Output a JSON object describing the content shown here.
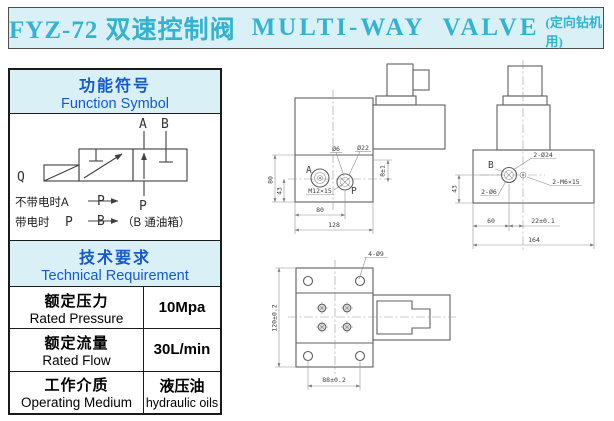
{
  "title": {
    "cn": "FYZ-72 双速控制阀",
    "en": "MULTI-WAY  VALVE",
    "note": "(定向钻机用)"
  },
  "function_symbol": {
    "title_cn": "功能符号",
    "title_en": "Function Symbol",
    "ports": {
      "a": "A",
      "b": "B",
      "p": "P",
      "q": "Q"
    },
    "notes": {
      "line1_prefix": "不带电时A",
      "line1_flow": "P",
      "line2_prefix": "带电时",
      "line2_port": "P",
      "line2_flow": "B",
      "line2_suffix": "（B 通油箱）"
    }
  },
  "technical": {
    "title_cn": "技术要求",
    "title_en": "Technical Requirement",
    "rows": [
      {
        "label_cn": "额定压力",
        "label_en": "Rated Pressure",
        "value": "10Mpa",
        "value_sub": ""
      },
      {
        "label_cn": "额定流量",
        "label_en": "Rated Flow",
        "value": "30L/min",
        "value_sub": ""
      },
      {
        "label_cn": "工作介质",
        "label_en": "Operating Medium",
        "value": "液压油",
        "value_sub": "hydraulic oils"
      }
    ]
  },
  "drawings": {
    "side_view": {
      "port_a": "A",
      "port_p": "P",
      "label_phi6": "Ø6",
      "label_phi22": "Ø22",
      "label_thread": "M12×15",
      "dim_height": "80",
      "dim_port_height": "43",
      "dim_depth": "8±1",
      "dim_port_x": "80",
      "dim_width": "128"
    },
    "front_view": {
      "port_b": "B",
      "label_bore": "2-Ø24",
      "label_thread": "2-M6×15",
      "label_phi6": "2-Ø6",
      "dim_port_height": "43",
      "dim_left": "60",
      "dim_offset": "22±0.1",
      "dim_width": "164"
    },
    "top_view": {
      "label_holes": "4-Ø9",
      "dim_height": "120±0.2",
      "dim_width": "88±0.2"
    }
  }
}
